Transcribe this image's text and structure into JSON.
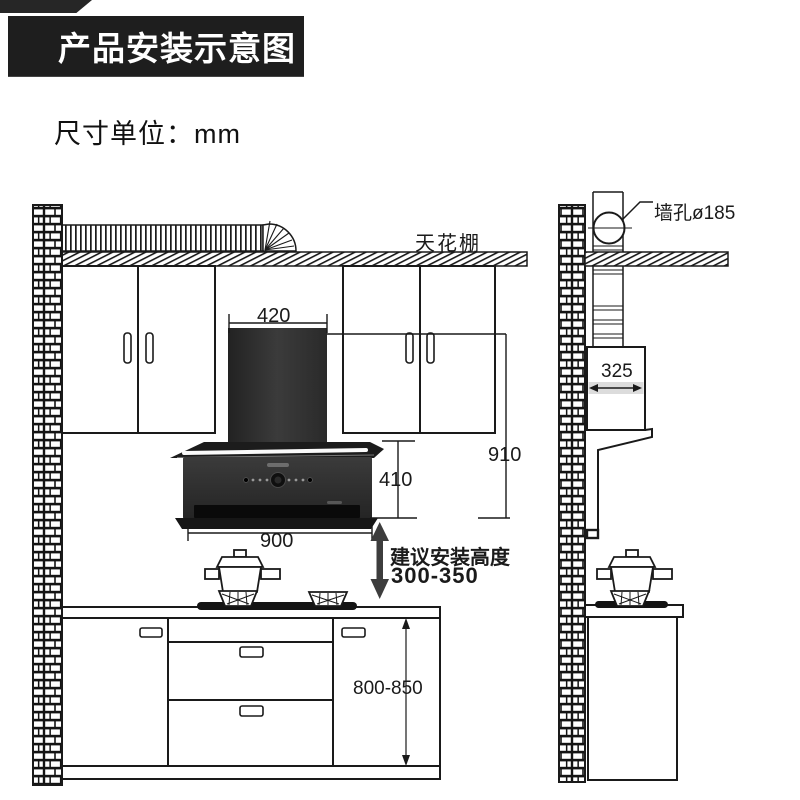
{
  "header": {
    "title": "产品安装示意图",
    "unit_label": "尺寸单位：mm"
  },
  "labels": {
    "ceiling": "天花棚",
    "wall_hole": "墙孔ø185",
    "advice_line1": "建议安装高度",
    "advice_line2": "300-350"
  },
  "dimensions": {
    "hood_top_width": "420",
    "hood_total_height": "910",
    "hood_body_height": "410",
    "hood_body_width": "900",
    "hood_side_depth": "325",
    "counter_height": "800-850"
  },
  "colors": {
    "banner_bg": "#1e1e1e",
    "banner_text": "#ffffff",
    "line": "#1a1a1a",
    "hood_dark": "#2b2b2b",
    "depth_band_gray": "#dcdcdc",
    "arrow_gray": "#3d3d3d"
  }
}
